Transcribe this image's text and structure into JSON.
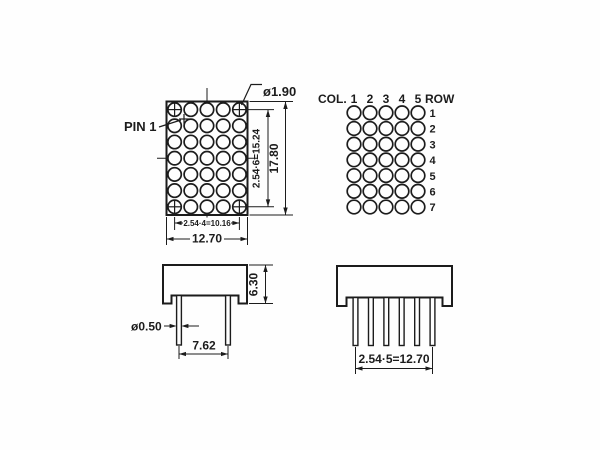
{
  "background": "#fefefe",
  "line_color": "#1c1c1c",
  "views": {
    "face": {
      "grid_rows": 7,
      "grid_cols": 5,
      "labels": {
        "dot_diameter": "ø1.90",
        "pin1": "PIN 1",
        "row_pitch_total": "2.54·6=15.24",
        "overall_height": "17.80",
        "col_pitch_total": "2.54·4=10.16",
        "overall_width": "12.70"
      }
    },
    "pin_map": {
      "grid_rows": 7,
      "grid_cols": 5,
      "col_label": "COL.",
      "row_label": "ROW",
      "col_numbers": [
        "1",
        "2",
        "3",
        "4",
        "5"
      ],
      "row_numbers": [
        "1",
        "2",
        "3",
        "4",
        "5",
        "6",
        "7"
      ]
    },
    "side": {
      "pin_count": 2,
      "labels": {
        "body_height": "6.30",
        "pin_diameter": "ø0.50",
        "pin_spacing": "7.62"
      }
    },
    "end": {
      "pin_count": 6,
      "labels": {
        "pin_pitch_total": "2.54·5=12.70"
      }
    }
  }
}
